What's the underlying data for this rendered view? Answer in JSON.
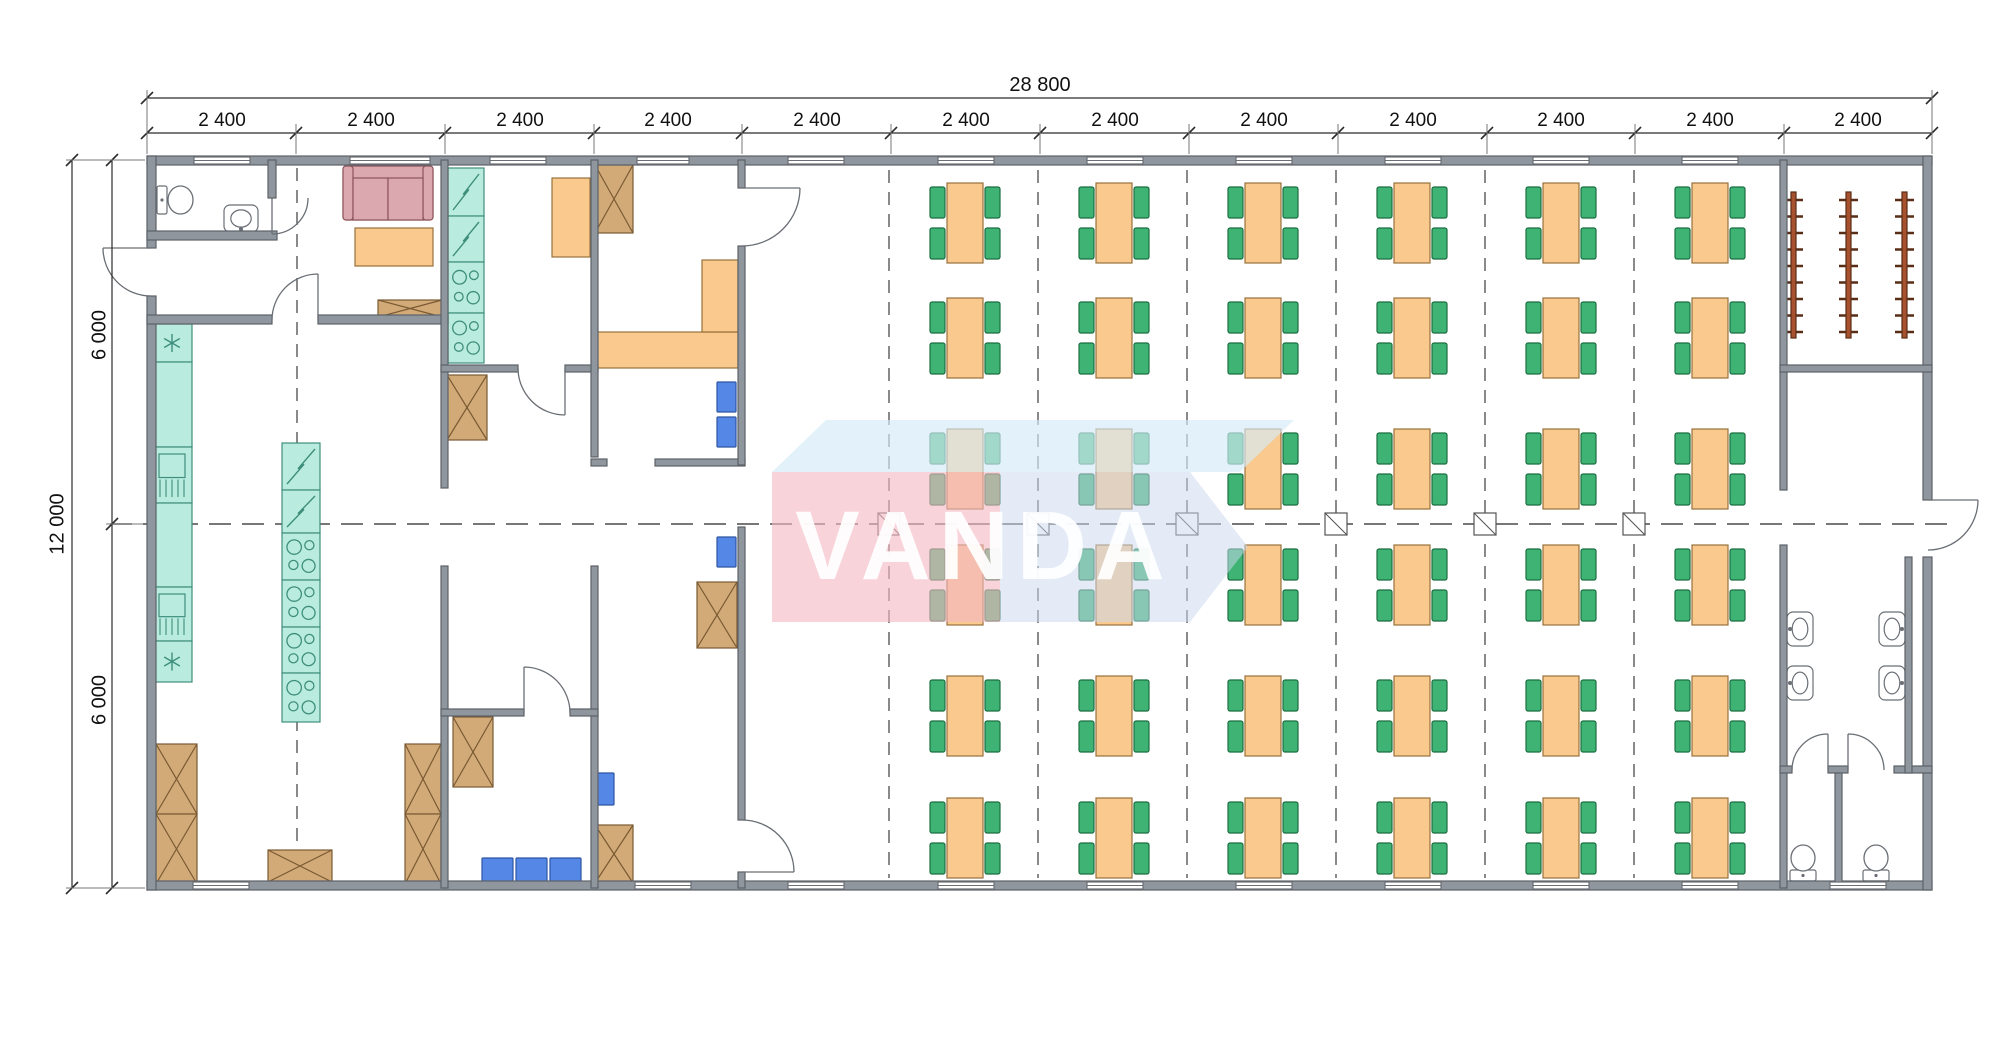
{
  "watermark": {
    "text": "VANDA"
  },
  "dimensions": {
    "total_width": "28 800",
    "total_height": "12 000",
    "bay_labels": [
      "2 400",
      "2 400",
      "2 400",
      "2 400",
      "2 400",
      "2 400",
      "2 400",
      "2 400",
      "2 400",
      "2 400",
      "2 400",
      "2 400"
    ],
    "half_labels": [
      "6 000",
      "6 000"
    ]
  },
  "colors": {
    "wall": "#8f969e",
    "wallStroke": "#5d6268",
    "teal": "#b9ecdf",
    "tealStroke": "#3f8e7c",
    "orange": "#f9c98e",
    "orangeStroke": "#97713c",
    "crate": "#d2aa78",
    "crateStroke": "#7a5a33",
    "green": "#3fb374",
    "greenStroke": "#1b6e41",
    "blue": "#5587e6",
    "blueStroke": "#2d55a3",
    "sofa": "#dba8af",
    "sofaStroke": "#8d545c",
    "rail": "#a8512e",
    "railStroke": "#5a2d16",
    "dash": "#4a4a4a",
    "dim": "#2b2b2b",
    "fixture": "#ffffff",
    "fixtureStroke": "#6a6f75",
    "wmPink": "rgba(243,184,193,0.62)",
    "wmTop": "rgba(213,235,248,0.66)",
    "wmBody": "rgba(203,217,237,0.52)"
  },
  "plan": {
    "canvas": {
      "w": 2000,
      "h": 1041
    },
    "walls": [
      [
        147,
        156,
        1785,
        9
      ],
      [
        147,
        881,
        1785,
        9
      ],
      [
        147,
        156,
        9,
        92
      ],
      [
        147,
        296,
        9,
        594
      ],
      [
        1923,
        156,
        9,
        344
      ],
      [
        1923,
        557,
        9,
        333
      ],
      [
        268,
        160,
        8,
        38
      ],
      [
        147,
        231,
        130,
        9
      ],
      [
        147,
        315,
        125,
        9
      ],
      [
        318,
        315,
        130,
        9
      ],
      [
        441,
        160,
        7,
        328
      ],
      [
        441,
        566,
        7,
        322
      ],
      [
        441,
        365,
        77,
        7
      ],
      [
        565,
        365,
        33,
        7
      ],
      [
        591,
        160,
        7,
        297
      ],
      [
        591,
        566,
        7,
        322
      ],
      [
        655,
        459,
        90,
        7
      ],
      [
        591,
        459,
        16,
        7
      ],
      [
        738,
        160,
        7,
        28
      ],
      [
        738,
        246,
        7,
        219
      ],
      [
        738,
        527,
        7,
        293
      ],
      [
        738,
        872,
        7,
        16
      ],
      [
        441,
        709,
        83,
        7
      ],
      [
        570,
        709,
        28,
        7
      ],
      [
        1780,
        160,
        7,
        330
      ],
      [
        1780,
        545,
        7,
        343
      ],
      [
        1780,
        365,
        152,
        7
      ],
      [
        1780,
        766,
        12,
        7
      ],
      [
        1828,
        766,
        20,
        7
      ],
      [
        1894,
        766,
        38,
        7
      ],
      [
        1835,
        773,
        7,
        115
      ],
      [
        1905,
        557,
        7,
        216
      ]
    ],
    "windows": [
      [
        194,
        157,
        56
      ],
      [
        350,
        157,
        80
      ],
      [
        490,
        157,
        56
      ],
      [
        637,
        157,
        52
      ],
      [
        788,
        157,
        56
      ],
      [
        938,
        157,
        56
      ],
      [
        1087,
        157,
        56
      ],
      [
        1236,
        157,
        56
      ],
      [
        1385,
        157,
        56
      ],
      [
        1533,
        157,
        56
      ],
      [
        1682,
        157,
        56
      ],
      [
        193,
        882,
        56
      ],
      [
        635,
        882,
        56
      ],
      [
        788,
        882,
        56
      ],
      [
        938,
        882,
        56
      ],
      [
        1087,
        882,
        56
      ],
      [
        1236,
        882,
        56
      ],
      [
        1385,
        882,
        56
      ],
      [
        1533,
        882,
        56
      ],
      [
        1682,
        882,
        56
      ],
      [
        1830,
        882,
        56
      ]
    ],
    "dashes": {
      "center": [
        110,
        524,
        1958,
        524
      ],
      "verticals": [
        [
          297,
          168,
          878
        ],
        [
          889,
          170,
          878
        ],
        [
          1038,
          170,
          878
        ],
        [
          1187,
          170,
          878
        ],
        [
          1336,
          170,
          878
        ],
        [
          1485,
          170,
          878
        ],
        [
          1634,
          170,
          878
        ]
      ]
    },
    "columns": {
      "xs": [
        889,
        1038,
        1187,
        1336,
        1485,
        1634
      ],
      "y": 524,
      "size": 22
    },
    "teal": [
      [
        "fridge",
        448,
        168,
        36,
        48
      ],
      [
        "fridge",
        448,
        216,
        36,
        46
      ],
      [
        "stove",
        448,
        262,
        36,
        51
      ],
      [
        "stove",
        448,
        313,
        36,
        50
      ],
      [
        "sinku",
        152,
        324,
        40,
        38
      ],
      [
        "counter",
        152,
        362,
        40,
        85
      ],
      [
        "dish",
        152,
        447,
        40,
        56
      ],
      [
        "counter",
        152,
        503,
        40,
        84
      ],
      [
        "dish",
        152,
        587,
        40,
        54
      ],
      [
        "sinku",
        152,
        641,
        40,
        41
      ],
      [
        "fridge",
        282,
        443,
        38,
        47
      ],
      [
        "fridge",
        282,
        490,
        38,
        43
      ],
      [
        "stove",
        282,
        533,
        38,
        47
      ],
      [
        "stove",
        282,
        580,
        38,
        47
      ],
      [
        "stove",
        282,
        627,
        38,
        46
      ],
      [
        "stove",
        282,
        673,
        38,
        49
      ]
    ],
    "service_tables": [
      [
        355,
        228,
        78,
        38
      ],
      [
        552,
        178,
        38,
        79
      ],
      [
        593,
        332,
        145,
        36
      ],
      [
        702,
        260,
        36,
        72
      ]
    ],
    "sofa": [
      343,
      166,
      90,
      54
    ],
    "crates": [
      [
        378,
        300,
        64,
        17
      ],
      [
        595,
        165,
        38,
        68
      ],
      [
        447,
        375,
        40,
        65
      ],
      [
        156,
        744,
        41,
        70
      ],
      [
        156,
        814,
        41,
        70
      ],
      [
        405,
        744,
        36,
        70
      ],
      [
        405,
        814,
        36,
        70
      ],
      [
        268,
        850,
        64,
        32
      ],
      [
        453,
        717,
        40,
        70
      ],
      [
        697,
        582,
        40,
        66
      ],
      [
        595,
        825,
        38,
        58
      ]
    ],
    "blue_chairs": [
      [
        717,
        382,
        19,
        30
      ],
      [
        717,
        417,
        19,
        30
      ],
      [
        717,
        537,
        19,
        30
      ],
      [
        595,
        773,
        19,
        32
      ],
      [
        482,
        858,
        31,
        25
      ],
      [
        516,
        858,
        31,
        25
      ],
      [
        550,
        858,
        31,
        25
      ]
    ],
    "dining": {
      "col_centers": [
        965,
        1114,
        1263,
        1412,
        1561,
        1710
      ],
      "row_centers": [
        223,
        338,
        469,
        585,
        716,
        838
      ],
      "table": {
        "w": 36,
        "h": 80
      },
      "chair": {
        "w": 15,
        "h": 31
      }
    },
    "rails": {
      "xs": [
        1791,
        1846,
        1902
      ],
      "y": 192,
      "h": 146,
      "w": 5,
      "hooks": 9
    },
    "basins": [
      [
        1787,
        612,
        26,
        34,
        "left"
      ],
      [
        1787,
        666,
        26,
        34,
        "left"
      ],
      [
        1879,
        612,
        26,
        34,
        "right"
      ],
      [
        1879,
        666,
        26,
        34,
        "right"
      ],
      [
        224,
        205,
        34,
        27,
        "bottom"
      ]
    ],
    "toilets": [
      [
        157,
        184,
        37,
        32,
        "e"
      ],
      [
        1788,
        842,
        30,
        40,
        "n"
      ],
      [
        1861,
        842,
        30,
        40,
        "n"
      ]
    ],
    "arcs": [
      [
        272,
        198,
        36,
        0,
        90,
        1
      ],
      [
        151,
        248,
        48,
        90,
        180,
        1
      ],
      [
        318,
        320,
        46,
        180,
        270,
        1
      ],
      [
        565,
        368,
        47,
        180,
        90,
        0
      ],
      [
        742,
        188,
        58,
        90,
        0,
        0
      ],
      [
        742,
        872,
        52,
        270,
        360,
        1
      ],
      [
        524,
        713,
        46,
        0,
        -90,
        0
      ],
      [
        1928,
        500,
        50,
        90,
        0,
        0
      ],
      [
        1828,
        770,
        36,
        180,
        270,
        1
      ],
      [
        1848,
        770,
        36,
        0,
        -90,
        0
      ]
    ],
    "dims": {
      "top_total": {
        "y": 98,
        "x1": 147,
        "x2": 1932,
        "ticks": [
          147,
          1932
        ]
      },
      "top_seg": {
        "y": 133,
        "x1": 147,
        "x2": 1932,
        "ticks": [
          147,
          296,
          445,
          594,
          742,
          891,
          1040,
          1189,
          1338,
          1487,
          1635,
          1784,
          1932
        ]
      },
      "left_total": {
        "x": 72,
        "y1": 160,
        "y2": 888,
        "ticks": [
          160,
          888
        ]
      },
      "left_seg": {
        "x": 112,
        "y1": 160,
        "y2": 888,
        "ticks": [
          160,
          524,
          888
        ]
      },
      "extensions": [
        [
          147,
          90,
          147,
          154
        ],
        [
          1932,
          90,
          1932,
          154
        ],
        [
          296,
          124,
          296,
          154
        ],
        [
          445,
          124,
          445,
          154
        ],
        [
          594,
          124,
          594,
          154
        ],
        [
          742,
          124,
          742,
          154
        ],
        [
          891,
          124,
          891,
          154
        ],
        [
          1040,
          124,
          1040,
          154
        ],
        [
          1189,
          124,
          1189,
          154
        ],
        [
          1338,
          124,
          1338,
          154
        ],
        [
          1487,
          124,
          1487,
          154
        ],
        [
          1635,
          124,
          1635,
          154
        ],
        [
          1784,
          124,
          1784,
          154
        ],
        [
          66,
          160,
          145,
          160
        ],
        [
          66,
          888,
          145,
          888
        ],
        [
          106,
          524,
          143,
          524
        ]
      ],
      "bay_label_xs": [
        222,
        371,
        520,
        668,
        817,
        966,
        1115,
        1264,
        1413,
        1561,
        1710,
        1858
      ]
    },
    "watermark_shapes": {
      "top_face": [
        [
          772,
          472
        ],
        [
          826,
          420
        ],
        [
          1294,
          420
        ],
        [
          1240,
          472
        ]
      ],
      "pink_face": [
        772,
        472,
        228,
        150
      ],
      "body": [
        1000,
        472,
        190,
        150
      ],
      "tip": [
        [
          1190,
          472
        ],
        [
          1248,
          547
        ],
        [
          1190,
          622
        ]
      ]
    }
  }
}
